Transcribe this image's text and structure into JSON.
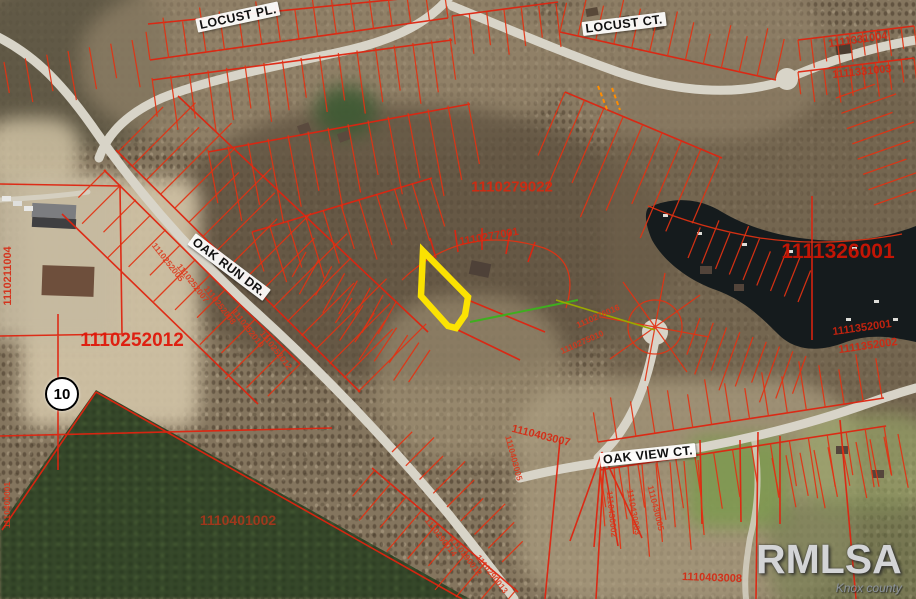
{
  "map": {
    "route_shield": {
      "number": "10"
    },
    "watermark": {
      "logo": "RMLSA",
      "region": "Knox county"
    },
    "highlight_color": "#ffe600",
    "parcel_line_color": "#e23212",
    "road_labels": [
      {
        "text": "LOCUST PL.",
        "x": 238,
        "y": 17,
        "rot": -12
      },
      {
        "text": "LOCUST CT.",
        "x": 624,
        "y": 24,
        "rot": -7
      },
      {
        "text": "OAK RUN DR.",
        "x": 229,
        "y": 267,
        "rot": 37
      },
      {
        "text": "OAK VIEW CT.",
        "x": 648,
        "y": 455,
        "rot": -6
      }
    ],
    "parcel_labels": [
      {
        "text": "1110279022",
        "x": 512,
        "y": 187,
        "rot": 0,
        "cls": "lg"
      },
      {
        "text": "1110252012",
        "x": 132,
        "y": 341,
        "rot": 0,
        "cls": "xl"
      },
      {
        "text": "1111326001",
        "x": 838,
        "y": 252,
        "rot": 0,
        "cls": "xxl"
      },
      {
        "text": "1110401002",
        "x": 238,
        "y": 520,
        "rot": 0,
        "cls": "dim"
      },
      {
        "text": "1110277001",
        "x": 489,
        "y": 237,
        "rot": -10,
        "cls": "md"
      },
      {
        "text": "1111331004",
        "x": 858,
        "y": 40,
        "rot": -8,
        "cls": "md"
      },
      {
        "text": "1111331003",
        "x": 862,
        "y": 72,
        "rot": -6,
        "cls": "md"
      },
      {
        "text": "1111352001",
        "x": 862,
        "y": 328,
        "rot": -8,
        "cls": "md"
      },
      {
        "text": "1111352002",
        "x": 868,
        "y": 346,
        "rot": -8,
        "cls": "md"
      },
      {
        "text": "1110403007",
        "x": 541,
        "y": 436,
        "rot": 14,
        "cls": "md"
      },
      {
        "text": "1110403005",
        "x": 514,
        "y": 458,
        "rot": 75,
        "cls": "sm"
      },
      {
        "text": "1110430002",
        "x": 612,
        "y": 514,
        "rot": 84,
        "cls": "sm"
      },
      {
        "text": "1110430003",
        "x": 634,
        "y": 512,
        "rot": 80,
        "cls": "sm"
      },
      {
        "text": "1110430005",
        "x": 656,
        "y": 508,
        "rot": 76,
        "cls": "sm"
      },
      {
        "text": "1110403008",
        "x": 712,
        "y": 578,
        "rot": 2,
        "cls": "md"
      },
      {
        "text": "1110211004",
        "x": 8,
        "y": 276,
        "rot": -90,
        "cls": "md"
      },
      {
        "text": "1110400001",
        "x": 7,
        "y": 505,
        "rot": -90,
        "cls": "sm"
      },
      {
        "text": "1110252005",
        "x": 168,
        "y": 262,
        "rot": 52,
        "cls": "sm"
      },
      {
        "text": "1110252007",
        "x": 193,
        "y": 283,
        "rot": 52,
        "cls": "sm"
      },
      {
        "text": "1110252008",
        "x": 220,
        "y": 305,
        "rot": 52,
        "cls": "sm"
      },
      {
        "text": "1110252010",
        "x": 248,
        "y": 328,
        "rot": 52,
        "cls": "sm"
      },
      {
        "text": "1110252012",
        "x": 276,
        "y": 350,
        "rot": 52,
        "cls": "sm"
      },
      {
        "text": "1110276016",
        "x": 598,
        "y": 316,
        "rot": -24,
        "cls": "sm"
      },
      {
        "text": "1110275010",
        "x": 582,
        "y": 342,
        "rot": -24,
        "cls": "sm"
      },
      {
        "text": "1110290012",
        "x": 466,
        "y": 556,
        "rot": 52,
        "cls": "sm"
      },
      {
        "text": "1110290013",
        "x": 492,
        "y": 574,
        "rot": 52,
        "cls": "sm"
      },
      {
        "text": "1110290014",
        "x": 441,
        "y": 537,
        "rot": 52,
        "cls": "sm"
      }
    ]
  }
}
